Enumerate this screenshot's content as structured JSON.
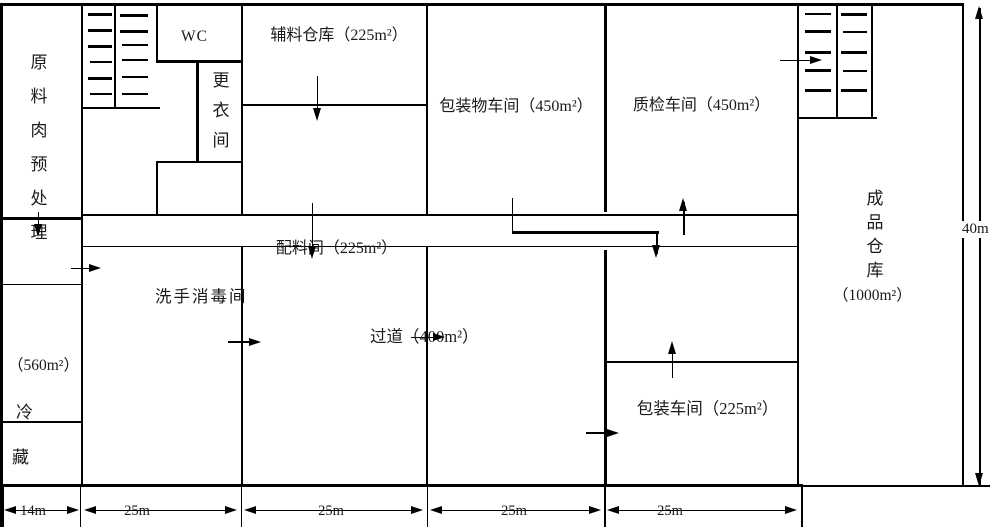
{
  "rooms": {
    "raw_meat_label": "原料肉预处理",
    "raw_meat_area": "（560m²）",
    "cold_char1": "冷",
    "cold_char2": "藏",
    "wc_label": "WC",
    "changing_room_label": "更衣间",
    "aux_warehouse_label": "辅料仓库（225m²）",
    "packing_materials_label": "包装物车间（450m²）",
    "quality_label": "质检车间（450m²）",
    "ingredients_label": "配料间（225m²）",
    "handwash_label": "洗手消毒间",
    "corridor_label": "过道（400m²）",
    "packing_workshop_label": "包装车间（225m²）",
    "finished_goods_label": "成品仓库",
    "finished_goods_area": "（1000m²）"
  },
  "dimensions": {
    "col1": "14m",
    "col2": "25m",
    "col3": "25m",
    "col4": "25m",
    "col5": "25m",
    "height": "40m"
  },
  "colors": {
    "line": "#000000",
    "background": "#ffffff"
  }
}
